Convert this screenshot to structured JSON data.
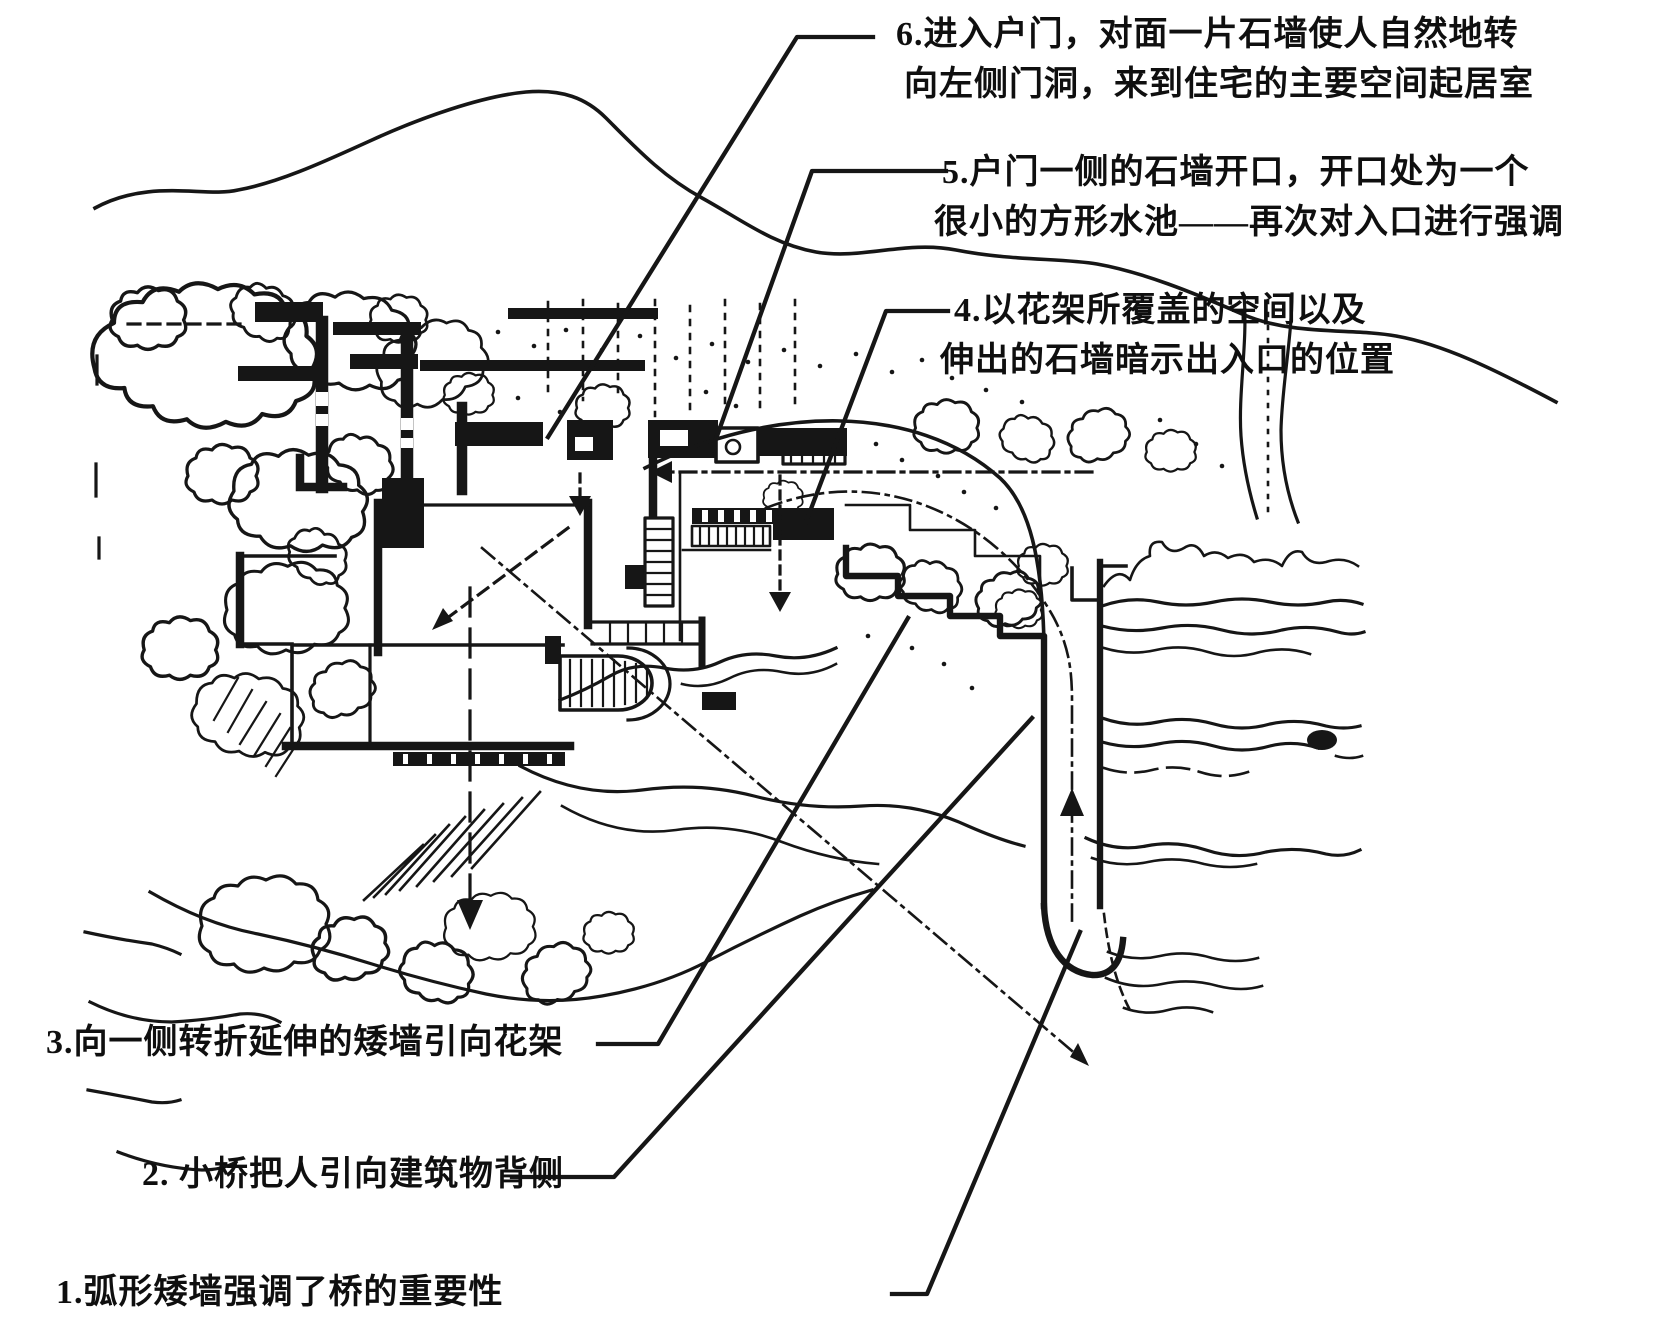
{
  "figure": {
    "ink_color": "#161616",
    "paper_color": "#ffffff"
  },
  "annotations": [
    {
      "id": "note-6",
      "lines": [
        "6.进入户门，对面一片石墙使人自然地转",
        "向左侧门洞，来到住宅的主要空间起居室"
      ]
    },
    {
      "id": "note-5",
      "lines": [
        "5.户门一侧的石墙开口，开口处为一个",
        "很小的方形水池——再次对入口进行强调"
      ]
    },
    {
      "id": "note-4",
      "lines": [
        "4.以花架所覆盖的空间以及",
        "伸出的石墙暗示出入口的位置"
      ]
    },
    {
      "id": "note-3",
      "lines": [
        "3.向一侧转折延伸的矮墙引向花架"
      ]
    },
    {
      "id": "note-2",
      "lines": [
        "2. 小桥把人引向建筑物背侧"
      ]
    },
    {
      "id": "note-1",
      "lines": [
        "1.弧形矮墙强调了桥的重要性"
      ]
    }
  ]
}
